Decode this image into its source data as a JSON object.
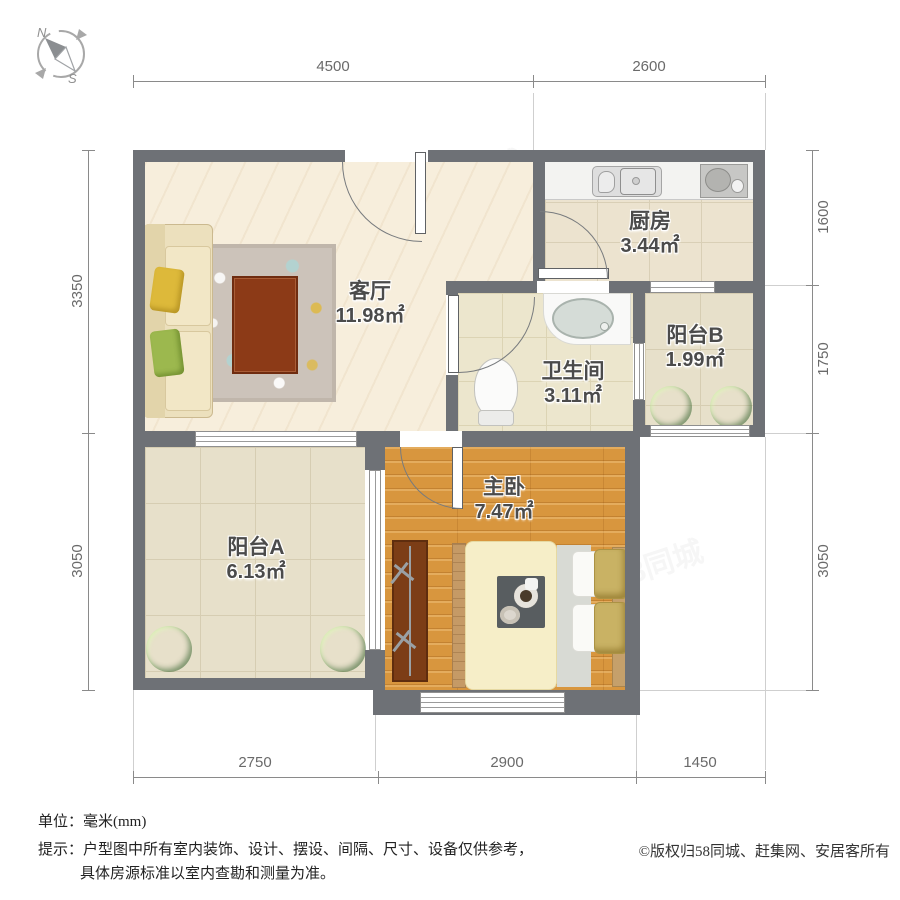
{
  "compass": {
    "north": "N",
    "south": "S"
  },
  "dimensions": {
    "top": [
      {
        "label": "4500"
      },
      {
        "label": "2600"
      }
    ],
    "bottom": [
      {
        "label": "2750"
      },
      {
        "label": "2900"
      },
      {
        "label": "1450"
      }
    ],
    "left": [
      {
        "label": "3350"
      },
      {
        "label": "3050"
      }
    ],
    "right": [
      {
        "label": "1600"
      },
      {
        "label": "1750"
      },
      {
        "label": "3050"
      }
    ]
  },
  "rooms": {
    "living": {
      "name": "客厅",
      "area": "11.98㎡"
    },
    "kitchen": {
      "name": "厨房",
      "area": "3.44㎡"
    },
    "bathroom": {
      "name": "卫生间",
      "area": "3.11㎡"
    },
    "balcony_b": {
      "name": "阳台B",
      "area": "1.99㎡"
    },
    "balcony_a": {
      "name": "阳台A",
      "area": "6.13㎡"
    },
    "bedroom": {
      "name": "主卧",
      "area": "7.47㎡"
    }
  },
  "footer": {
    "unit_line": "单位：毫米(mm)",
    "tip_line1": "提示：户型图中所有室内装饰、设计、摆设、间隔、尺寸、设备仅供参考，",
    "tip_line2": "具体房源标准以室内查勘和测量为准。",
    "copyright": "©版权归58同城、赶集网、安居客所有"
  },
  "watermark": {
    "text": "58同城"
  },
  "colors": {
    "wall": "#6e7176",
    "wood_floor": "#d8963e",
    "tile_floor": "#e7e0ca",
    "living_floor": "#f7eedc",
    "plant_green": "#3d9e33",
    "dimension_text": "#6a6a6a"
  }
}
